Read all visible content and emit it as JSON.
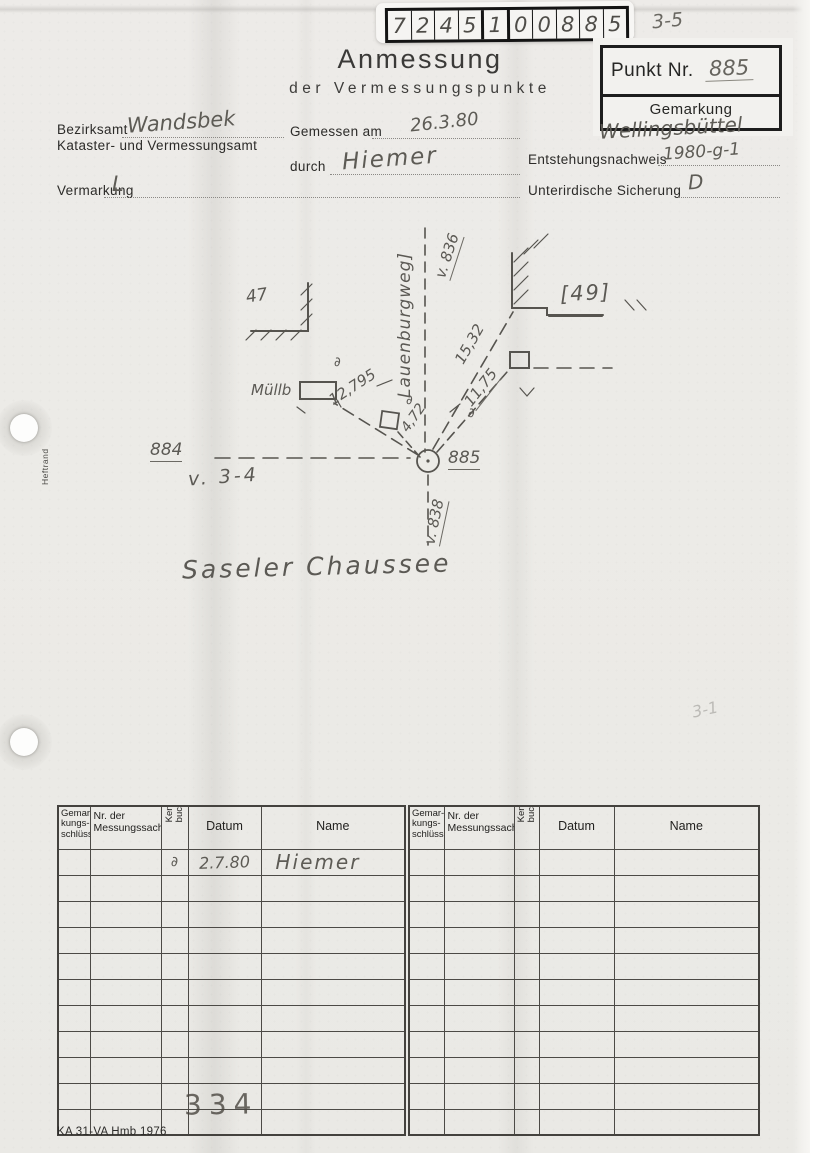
{
  "colors": {
    "paper": "#ecebe7",
    "ink": "#2c2b29",
    "pencil": "#5d5b55",
    "line": "#4c4a46"
  },
  "header": {
    "digit_code": [
      "7",
      "2",
      "4",
      "5",
      "1",
      "0",
      "0",
      "8",
      "8",
      "5"
    ],
    "page_ref": "3-5",
    "title": "Anmessung",
    "subtitle": "der Vermessungspunkte",
    "punkt_nr_label": "Punkt Nr.",
    "punkt_nr_value": "885",
    "gemarkung_label": "Gemarkung",
    "gemarkung_value": "Wellingsbüttel"
  },
  "form": {
    "bezirksamt_label": "Bezirksamt",
    "bezirksamt_value": "Wandsbek",
    "kataster_label": "Kataster- und Vermessungsamt",
    "gemessen_am_label": "Gemessen am",
    "gemessen_am_value": "26.3.80",
    "durch_label": "durch",
    "durch_value": "Hiemer",
    "entstehungsnachweis_label": "Entstehungsnachweis",
    "entstehungsnachweis_value": "1980-g-1",
    "vermarkung_label": "Vermarkung",
    "vermarkung_value": "L",
    "unterirdische_label": "Unterirdische Sicherung",
    "unterirdische_value": "D"
  },
  "sketch": {
    "street_name_vertical": "Lauenburgweg]",
    "ref_836": "v. 836",
    "ref_838": "v. 838",
    "ref_3_4": "v. 3-4",
    "parcel_left": "47",
    "parcel_right": "[49]",
    "muellb_label": "Müllb",
    "meas_12795": "12,795",
    "meas_4_72": "4,72",
    "meas_15_32": "15,32",
    "meas_11_75": "11,75",
    "partial_symbol": "∂",
    "point_main": "885",
    "point_left": "884",
    "street_name_bottom": "Saseler Chaussee",
    "faint_note": "3-1"
  },
  "margin": {
    "heftrand": "Heftrand"
  },
  "table": {
    "header": {
      "gemarkungsschluessel": "Gemar-\nkungs-\nschlüssel",
      "nr_messungssache": "Nr. der\nMessungssache",
      "kennbuchst": "Kenn-\nbuchst.",
      "datum": "Datum",
      "name": "Name"
    },
    "row_count": 11,
    "entry": {
      "kennbuchst": "∂",
      "datum": "2.7.80",
      "name": "Hiemer"
    },
    "stamp": "334"
  },
  "footer": {
    "form_id": "KA 31-VA Hmb 1976"
  }
}
